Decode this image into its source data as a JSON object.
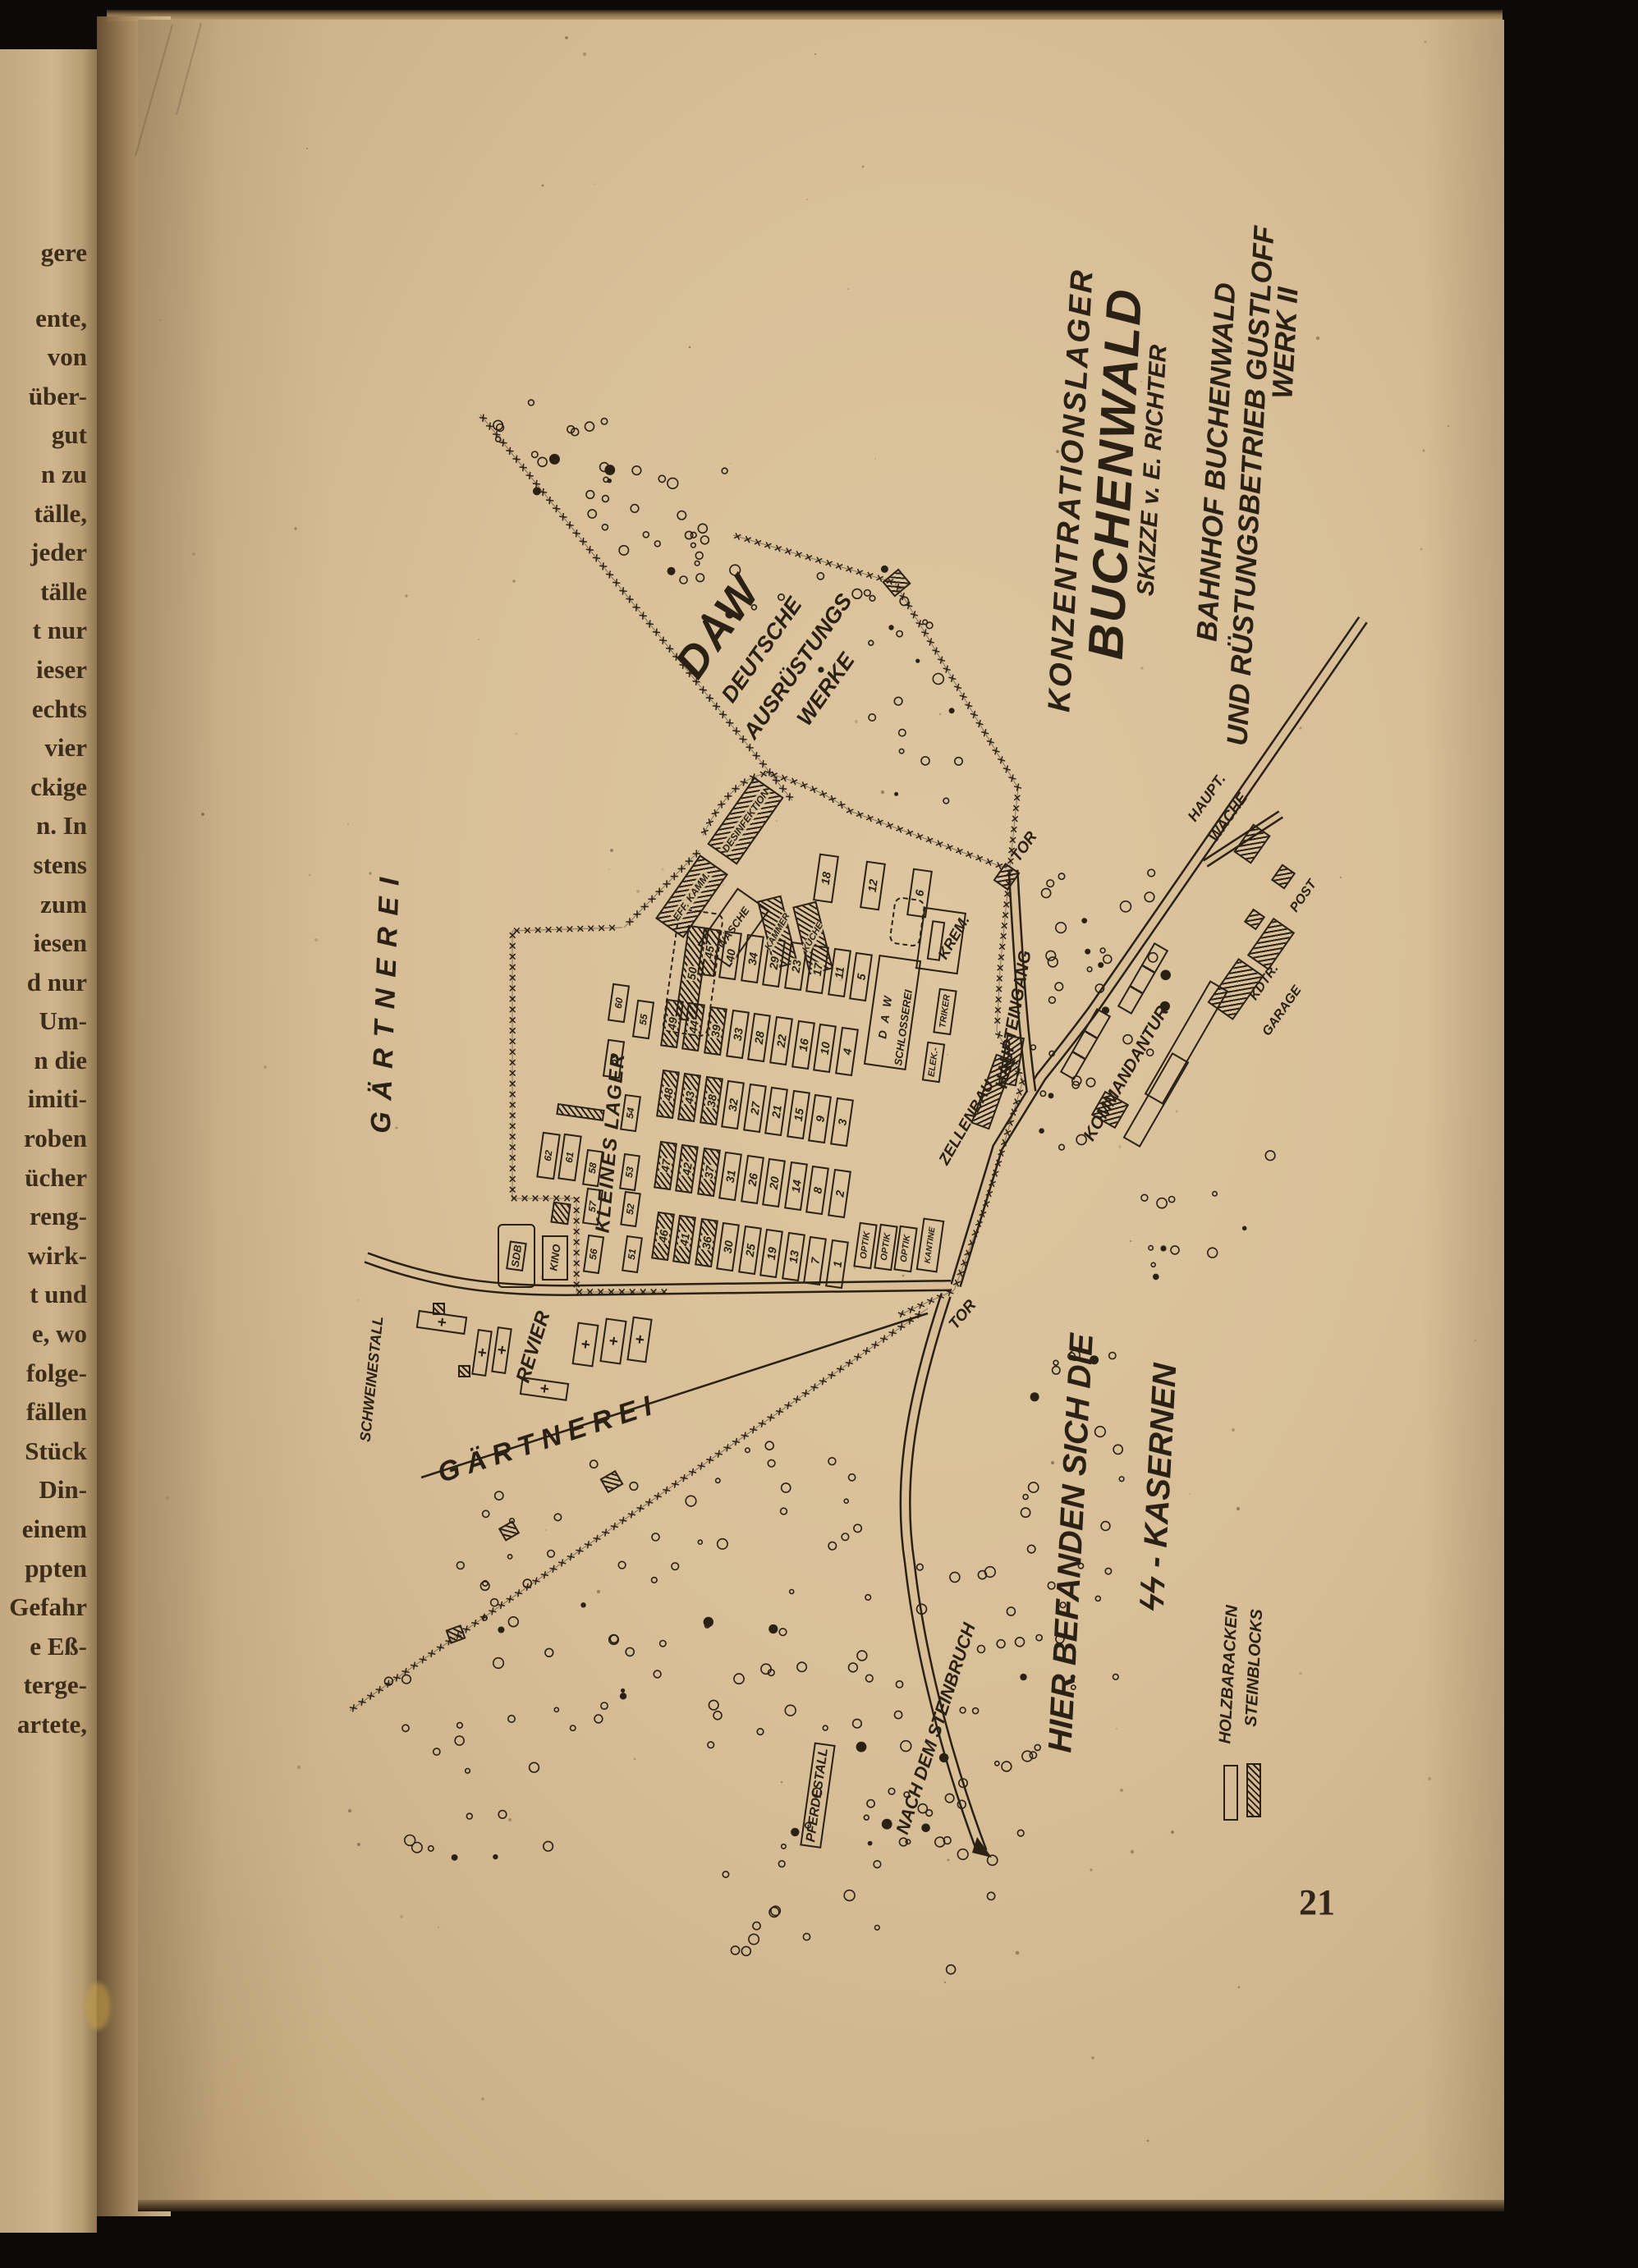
{
  "left_page": {
    "fragments": [
      "gere",
      "ente,",
      "von",
      "über-",
      "gut",
      "n zu",
      "tälle,",
      "jeder",
      "tälle",
      "t nur",
      "ieser",
      "echts",
      "vier",
      "ckige",
      "n. In",
      "stens",
      "zum",
      "iesen",
      "d nur",
      "Um-",
      "n die",
      "imiti-",
      "roben",
      "ücher",
      "reng-",
      "wirk-",
      "t und",
      "e, wo",
      "folge-",
      "fällen",
      "Stück",
      "Din-",
      "einem",
      "ppten",
      "Gefahr",
      "e Eß-",
      "terge-",
      "artete,"
    ]
  },
  "page": {
    "number": "21"
  },
  "map": {
    "title": {
      "l1": "KONZENTRATIONSLAGER",
      "l2": "BUCHENWALD",
      "l3": "SKIZZE v. E. RICHTER"
    },
    "caption": {
      "l1": "BAHNHOF BUCHENWALD",
      "l2": "UND RÜSTUNGSBETRIEB GUSTLOFF",
      "l3": "WERK II"
    },
    "daw": {
      "l1": "DAW",
      "l2": "DEUTSCHE",
      "l3": "AUSRÜSTUNGS",
      "l4": "WERKE"
    },
    "areas": {
      "gaertnerei_west": "GÄRTNEREI",
      "gaertnerei_south": "GÄRTNEREI",
      "kleines_lager": "KLEINES LAGER",
      "revier": "REVIER",
      "schweinestall": "SCHWEINESTALL",
      "pferdestall": "PFERDESTALL",
      "steinbruch_road": "NACH DEM STEINBRUCH",
      "ss_line1": "HIER BEFANDEN SICH DIE",
      "ss_line2": "ϟϟ - KASERNEN"
    },
    "gates": {
      "tor_north": "TOR",
      "tor_south": "TOR",
      "haupteingang": "HAUPTEINGANG",
      "zellenbau": "ZELLENBAU"
    },
    "ss_buildings": {
      "kommandantur": "KOMMANDANTUR",
      "hauptwache_1": "HAUPT.",
      "hauptwache_2": "WACHE",
      "post": "POST",
      "kdtr": "KDTR.",
      "garage": "GARAGE"
    },
    "camp_buildings": {
      "krem": "KREM.",
      "desinfektion": "DESINFEKTION",
      "effektenkammer": "EFF. KAMM.",
      "waesche": "WÄSCHE",
      "kammer": "KAMMER",
      "kueche": "KÜCHE",
      "daw_short": "D A W",
      "schlosserei": "SCHLOSSEREI",
      "elektriker_1": "ELEK.-",
      "elektriker_2": "TRIKER",
      "optik": "OPTIK",
      "kantine": "KANTINE",
      "sdb": "SDB",
      "kino": "KINO"
    },
    "legend": {
      "holzbaracken": "HOLZBARACKEN",
      "steinblocks": "STEINBLOCKS"
    },
    "block50": "50",
    "camp_rows": [
      {
        "blocks": [
          "18",
          "12",
          "6"
        ],
        "hatched": []
      },
      {
        "blocks": [
          "45",
          "40",
          "34",
          "29",
          "23",
          "17",
          "11",
          "5"
        ],
        "hatched": [
          "45"
        ]
      },
      {
        "blocks": [
          "49",
          "44",
          "39",
          "33",
          "28",
          "22",
          "16",
          "10",
          "4"
        ],
        "hatched": [
          "49",
          "44",
          "39"
        ]
      },
      {
        "blocks": [
          "48",
          "43",
          "38",
          "32",
          "27",
          "21",
          "15",
          "9",
          "3"
        ],
        "hatched": [
          "48",
          "43",
          "38"
        ]
      },
      {
        "blocks": [
          "47",
          "42",
          "37",
          "31",
          "26",
          "20",
          "14",
          "8",
          "2"
        ],
        "hatched": [
          "47",
          "42",
          "37"
        ]
      },
      {
        "blocks": [
          "46",
          "41",
          "36",
          "30",
          "25",
          "19",
          "13",
          "7",
          "1"
        ],
        "hatched": [
          "46",
          "41",
          "36"
        ]
      }
    ],
    "kleines_lager_blocks": [
      "62",
      "61",
      "60",
      "59",
      "58",
      "57",
      "56",
      "55",
      "54",
      "53",
      "52",
      "51"
    ]
  }
}
